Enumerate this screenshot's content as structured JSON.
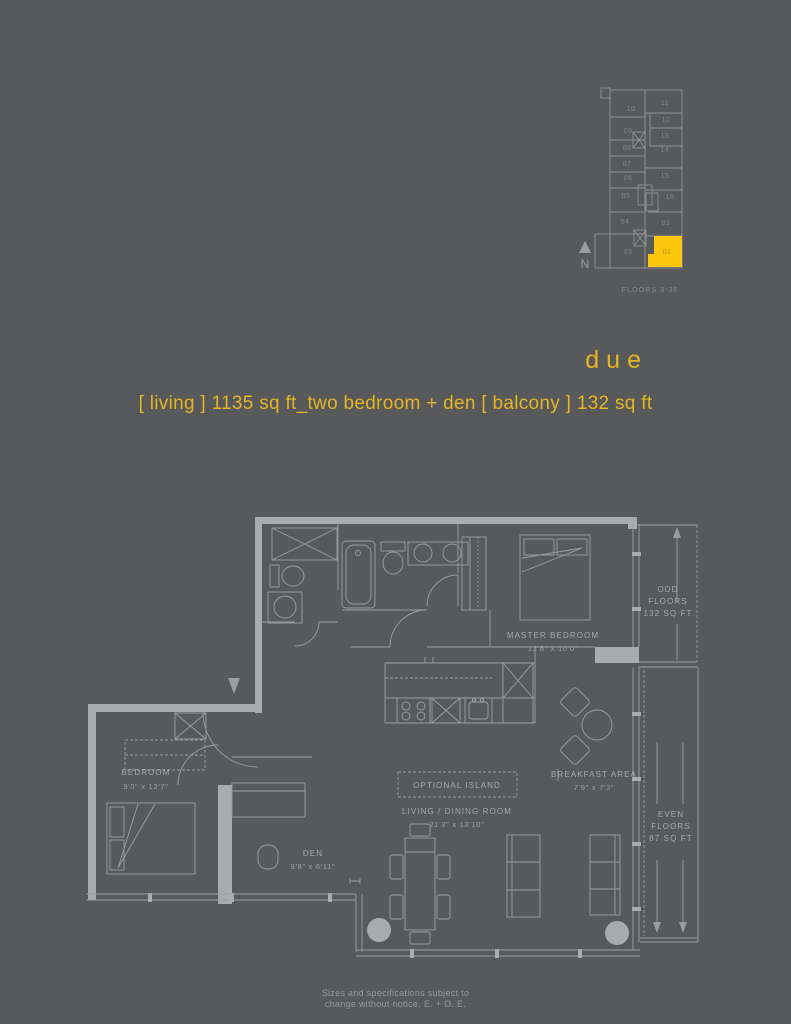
{
  "page": {
    "bg_color": "#58595b",
    "accent_yellow": "#fcc60d",
    "text_yellow": "#e3b622"
  },
  "header": {
    "title": "due",
    "subtitle": "[ living ] 1135 sq ft_two bedroom + den [ balcony ] 132 sq ft"
  },
  "keyplan": {
    "units": [
      "10",
      "09",
      "08",
      "07",
      "06",
      "05",
      "04",
      "03",
      "11",
      "12",
      "13",
      "14",
      "15",
      "16",
      "01",
      "02"
    ],
    "highlight_unit": "02",
    "floors_label": "FLOORS 3-35",
    "north_label": "N"
  },
  "plan": {
    "master_bedroom": {
      "name": "MASTER BEDROOM",
      "dims": "12'6\" x 10'0\""
    },
    "bedroom": {
      "name": "BEDROOM",
      "dims": "9'0\" x 12'7\""
    },
    "den": {
      "name": "DEN",
      "dims": "9'8\" x 6'11\""
    },
    "living_dining": {
      "name": "LIVING / DINING ROOM",
      "dims": "21'3\" x 13'10\""
    },
    "breakfast_area": {
      "name": "BREAKFAST AREA",
      "dims": "7'9\" x 7'3\""
    },
    "optional_island": {
      "label": "OPTIONAL ISLAND"
    },
    "balcony_odd": {
      "line1": "ODD",
      "line2": "FLOORS",
      "line3": "132 SQ FT"
    },
    "balcony_even": {
      "line1": "EVEN",
      "line2": "FLOORS",
      "line3": "87 SQ FT"
    }
  },
  "footer": {
    "line1": "Sizes and specifications subject to",
    "line2": "change without notice. E. + O. E."
  }
}
